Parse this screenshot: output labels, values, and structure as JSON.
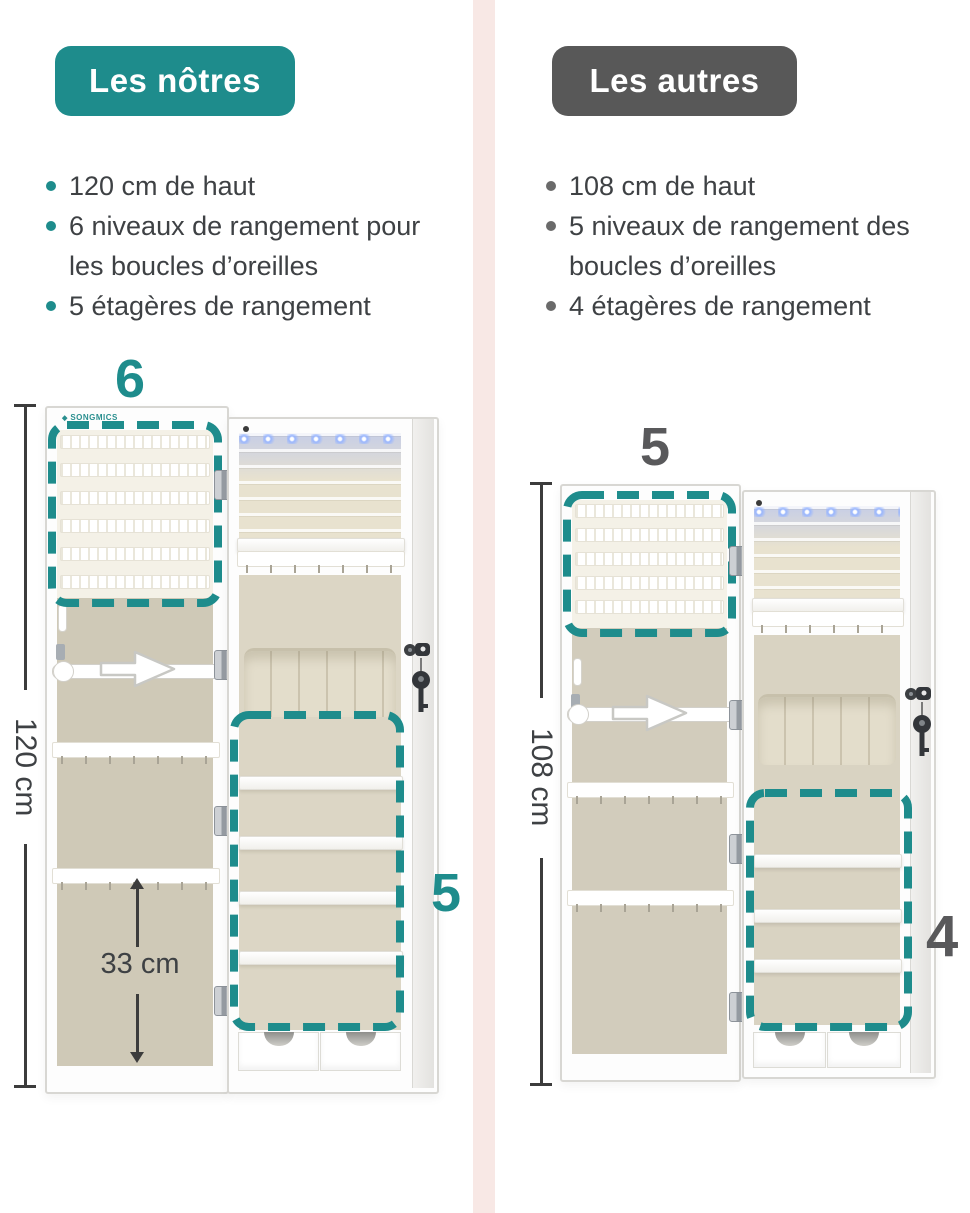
{
  "page": {
    "accent_teal": "#1e8c8c",
    "accent_gray": "#585858",
    "divider_color": "#f8e8e5"
  },
  "ours": {
    "badge_label": "Les nôtres",
    "bullets": [
      "120 cm de haut",
      "6 niveaux de rangement pour les boucles d’oreilles",
      "5 étagères de rangement"
    ],
    "door_levels_count": "6",
    "shelves_count": "5",
    "height_label": "120 cm",
    "inner_height_label": "33 cm",
    "brand": "SONGMICS"
  },
  "others": {
    "badge_label": "Les autres",
    "bullets": [
      "108 cm de haut",
      "5 niveaux de rangement des boucles d’oreilles",
      "4 étagères de rangement"
    ],
    "door_levels_count": "5",
    "shelves_count": "4",
    "height_label": "108 cm"
  }
}
